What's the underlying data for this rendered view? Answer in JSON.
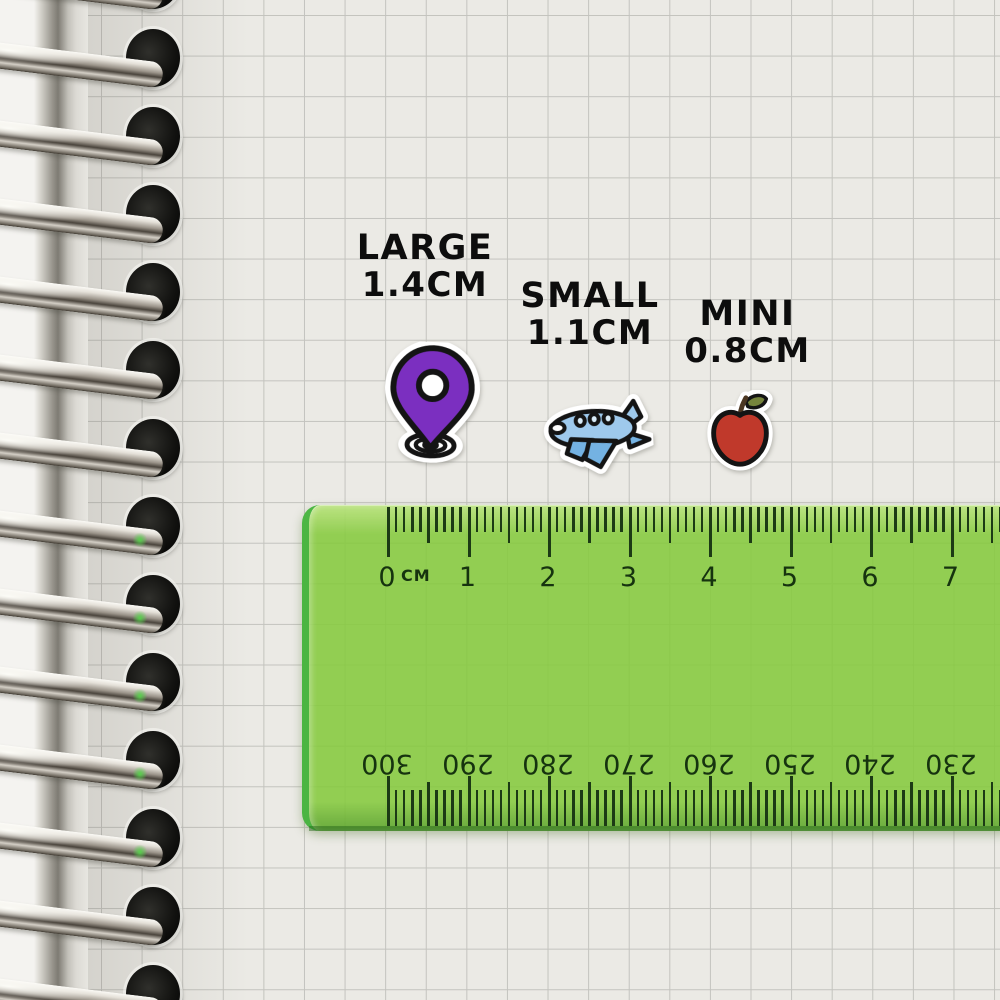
{
  "size_labels": [
    {
      "id": "large",
      "title": "LARGE",
      "size": "1.4CM"
    },
    {
      "id": "small",
      "title": "SMALL",
      "size": "1.1CM"
    },
    {
      "id": "mini",
      "title": "MINI",
      "size": "0.8CM"
    }
  ],
  "stickers": {
    "pin": {
      "name": "location-pin",
      "fill": "#7b2fc0",
      "outline": "#141414"
    },
    "plane": {
      "name": "airplane",
      "body_fill": "#9ec9ec",
      "wing_fill": "#74b2e2",
      "window_fill": "#d9ecf8",
      "outline": "#141414"
    },
    "apple": {
      "name": "apple",
      "fill": "#c0392b",
      "leaf_fill": "#75843c",
      "stem_fill": "#4c3722",
      "outline": "#141414"
    }
  },
  "ruler": {
    "unit_label": "CM",
    "top_scale": {
      "labels": [
        "0",
        "1",
        "2",
        "3",
        "4",
        "5",
        "6",
        "7"
      ]
    },
    "bottom_scale": {
      "labels": [
        "300",
        "290",
        "280",
        "270",
        "260",
        "250",
        "240",
        "230"
      ]
    },
    "colors": {
      "body": "#85c93e",
      "markings": "#1c3a15"
    }
  }
}
